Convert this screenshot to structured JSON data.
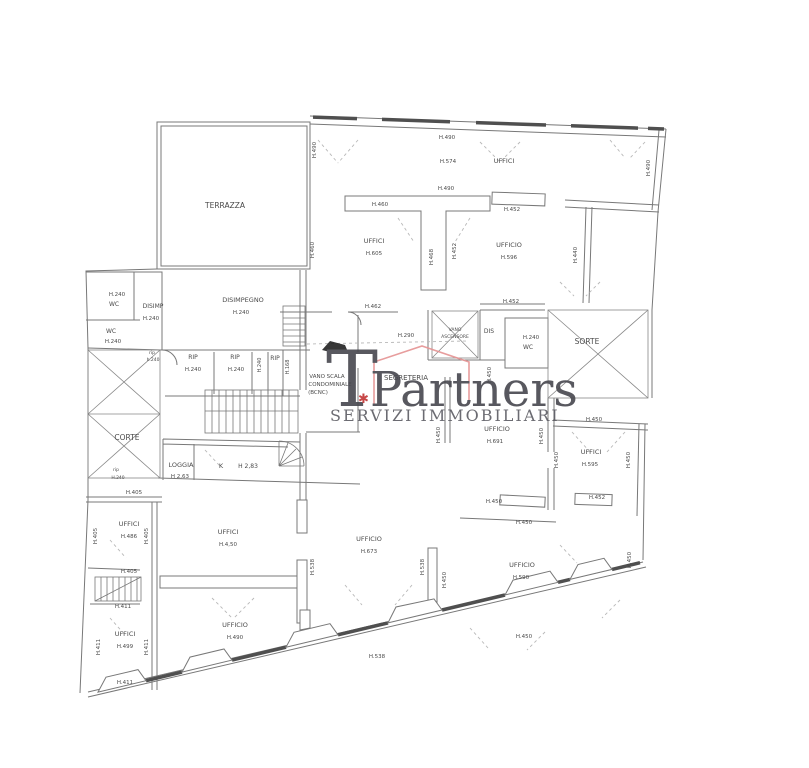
{
  "watermark": {
    "t_letter": "T",
    "brand": "Partners",
    "tagline": "SERVIZI IMMOBILIARI",
    "accent_mark": "✱",
    "brand_color": "#47474e",
    "tagline_color": "#5c5c63",
    "roof_color": "#e59393",
    "accent_color": "#c13434"
  },
  "plan": {
    "wall_color": "#787878",
    "thick_wall_color": "#4f4f4f",
    "dash_color": "#b8b8b8",
    "label_color": "#4a4a4a",
    "labels": [
      {
        "t": "TERRAZZA",
        "x": 225,
        "y": 208,
        "s": 7.5
      },
      {
        "t": "H.490",
        "x": 316,
        "y": 150,
        "s": 5.5,
        "r": -90
      },
      {
        "t": "H.460",
        "x": 314,
        "y": 250,
        "s": 5.5,
        "r": -90
      },
      {
        "t": "H.490",
        "x": 447,
        "y": 139,
        "s": 5.5
      },
      {
        "t": "H.574",
        "x": 448,
        "y": 163,
        "s": 5.5
      },
      {
        "t": "UFFICI",
        "x": 504,
        "y": 163,
        "s": 6.5
      },
      {
        "t": "H.490",
        "x": 650,
        "y": 168,
        "s": 5.5,
        "r": -90
      },
      {
        "t": "H.490",
        "x": 446,
        "y": 190,
        "s": 5.5
      },
      {
        "t": "H.460",
        "x": 380,
        "y": 206,
        "s": 5.5
      },
      {
        "t": "H.452",
        "x": 512,
        "y": 211,
        "s": 5.5
      },
      {
        "t": "UFFICI",
        "x": 374,
        "y": 243,
        "s": 6.5
      },
      {
        "t": "H.605",
        "x": 374,
        "y": 255,
        "s": 5.5
      },
      {
        "t": "H.468",
        "x": 433,
        "y": 257,
        "s": 5.5,
        "r": -90
      },
      {
        "t": "H.452",
        "x": 456,
        "y": 251,
        "s": 5.5,
        "r": -90
      },
      {
        "t": "UFFICIO",
        "x": 509,
        "y": 247,
        "s": 6.5
      },
      {
        "t": "H.596",
        "x": 509,
        "y": 259,
        "s": 5.5
      },
      {
        "t": "H.440",
        "x": 577,
        "y": 255,
        "s": 5.5,
        "r": -90
      },
      {
        "t": "H.240",
        "x": 117,
        "y": 296,
        "s": 5.5
      },
      {
        "t": "WC",
        "x": 114,
        "y": 306,
        "s": 6
      },
      {
        "t": "DISIMP",
        "x": 153,
        "y": 308,
        "s": 6
      },
      {
        "t": "H.240",
        "x": 151,
        "y": 320,
        "s": 5.5
      },
      {
        "t": "DISIMPEGNO",
        "x": 243,
        "y": 302,
        "s": 6.5
      },
      {
        "t": "H.240",
        "x": 241,
        "y": 314,
        "s": 5.5
      },
      {
        "t": "WC",
        "x": 111,
        "y": 333,
        "s": 6
      },
      {
        "t": "H.240",
        "x": 113,
        "y": 343,
        "s": 5.5
      },
      {
        "t": "rip",
        "x": 152,
        "y": 354,
        "s": 4.5
      },
      {
        "t": "h.240",
        "x": 153,
        "y": 361,
        "s": 4.5
      },
      {
        "t": "RIP",
        "x": 193,
        "y": 359,
        "s": 6
      },
      {
        "t": "H.240",
        "x": 193,
        "y": 371,
        "s": 5.5
      },
      {
        "t": "RIP",
        "x": 235,
        "y": 359,
        "s": 6
      },
      {
        "t": "H.240",
        "x": 236,
        "y": 371,
        "s": 5.5
      },
      {
        "t": "H.240",
        "x": 261,
        "y": 365,
        "s": 5,
        "r": -90
      },
      {
        "t": "RIP",
        "x": 275,
        "y": 360,
        "s": 6
      },
      {
        "t": "H.168",
        "x": 289,
        "y": 367,
        "s": 5,
        "r": -90
      },
      {
        "t": "H.462",
        "x": 373,
        "y": 308,
        "s": 5.5
      },
      {
        "t": "H.290",
        "x": 406,
        "y": 337,
        "s": 5.5
      },
      {
        "t": "VANO",
        "x": 455,
        "y": 331,
        "s": 4.5
      },
      {
        "t": "ASCENSORE",
        "x": 455,
        "y": 338,
        "s": 4.5
      },
      {
        "t": "DIS",
        "x": 489,
        "y": 333,
        "s": 6
      },
      {
        "t": "H.452",
        "x": 511,
        "y": 303,
        "s": 5.5
      },
      {
        "t": "H.240",
        "x": 531,
        "y": 339,
        "s": 5.5
      },
      {
        "t": "WC",
        "x": 528,
        "y": 349,
        "s": 6
      },
      {
        "t": "SORTE",
        "x": 587,
        "y": 344,
        "s": 7.5
      },
      {
        "t": "VANO SCALA",
        "x": 327,
        "y": 378,
        "s": 5.5
      },
      {
        "t": "CONDOMINIALE",
        "x": 330,
        "y": 386,
        "s": 5.5
      },
      {
        "t": "(BCNC)",
        "x": 318,
        "y": 394,
        "s": 5.5
      },
      {
        "t": "SEGRETERIA",
        "x": 406,
        "y": 380,
        "s": 7
      },
      {
        "t": "H.450",
        "x": 491,
        "y": 375,
        "s": 5.5,
        "r": -90
      },
      {
        "t": "H.450",
        "x": 594,
        "y": 421,
        "s": 5.5
      },
      {
        "t": "UFFICIO",
        "x": 497,
        "y": 431,
        "s": 6.5
      },
      {
        "t": "H.691",
        "x": 495,
        "y": 443,
        "s": 5.5
      },
      {
        "t": "H.450",
        "x": 440,
        "y": 435,
        "s": 5.5,
        "r": -90
      },
      {
        "t": "H.450",
        "x": 543,
        "y": 436,
        "s": 5.5,
        "r": -90
      },
      {
        "t": "H.450",
        "x": 558,
        "y": 460,
        "s": 5.5,
        "r": -90
      },
      {
        "t": "UFFICI",
        "x": 591,
        "y": 454,
        "s": 6.5
      },
      {
        "t": "H.595",
        "x": 590,
        "y": 466,
        "s": 5.5
      },
      {
        "t": "H.450",
        "x": 630,
        "y": 460,
        "s": 5.5,
        "r": -90
      },
      {
        "t": "CORTE",
        "x": 127,
        "y": 440,
        "s": 7.5
      },
      {
        "t": "rip",
        "x": 116,
        "y": 471,
        "s": 4.5
      },
      {
        "t": "H.240",
        "x": 118,
        "y": 479,
        "s": 4.5
      },
      {
        "t": "LOGGIA",
        "x": 181,
        "y": 467,
        "s": 6.5
      },
      {
        "t": "H 2,63",
        "x": 180,
        "y": 478,
        "s": 5.5
      },
      {
        "t": "K",
        "x": 221,
        "y": 468,
        "s": 6.5
      },
      {
        "t": "H 2,83",
        "x": 248,
        "y": 468,
        "s": 6
      },
      {
        "t": "H.405",
        "x": 134,
        "y": 494,
        "s": 5.5
      },
      {
        "t": "H.405",
        "x": 97,
        "y": 536,
        "s": 5.5,
        "r": -90
      },
      {
        "t": "UFFICI",
        "x": 129,
        "y": 526,
        "s": 6.5
      },
      {
        "t": "H.486",
        "x": 129,
        "y": 538,
        "s": 5.5
      },
      {
        "t": "H.405",
        "x": 148,
        "y": 536,
        "s": 5.5,
        "r": -90
      },
      {
        "t": "UFFICI",
        "x": 228,
        "y": 534,
        "s": 6.5
      },
      {
        "t": "H.4,50",
        "x": 228,
        "y": 546,
        "s": 5.5
      },
      {
        "t": "H.405",
        "x": 129,
        "y": 573,
        "s": 5.5
      },
      {
        "t": "H.411",
        "x": 123,
        "y": 608,
        "s": 5.5
      },
      {
        "t": "H.411",
        "x": 100,
        "y": 647,
        "s": 5.5,
        "r": -90
      },
      {
        "t": "UFFICI",
        "x": 125,
        "y": 636,
        "s": 6.5
      },
      {
        "t": "H.499",
        "x": 125,
        "y": 648,
        "s": 5.5
      },
      {
        "t": "H.411",
        "x": 148,
        "y": 647,
        "s": 5.5,
        "r": -90
      },
      {
        "t": "H.411",
        "x": 125,
        "y": 684,
        "s": 5.5
      },
      {
        "t": "UFFICIO",
        "x": 369,
        "y": 541,
        "s": 6.5
      },
      {
        "t": "H.673",
        "x": 369,
        "y": 553,
        "s": 5.5
      },
      {
        "t": "H.538",
        "x": 314,
        "y": 567,
        "s": 5.5,
        "r": -90
      },
      {
        "t": "H.538",
        "x": 424,
        "y": 567,
        "s": 5.5,
        "r": -90
      },
      {
        "t": "UFFICIO",
        "x": 235,
        "y": 627,
        "s": 6.5
      },
      {
        "t": "H.490",
        "x": 235,
        "y": 639,
        "s": 5.5
      },
      {
        "t": "H.538",
        "x": 377,
        "y": 658,
        "s": 5.5
      },
      {
        "t": "H.450",
        "x": 494,
        "y": 503,
        "s": 5.5
      },
      {
        "t": "H.452",
        "x": 597,
        "y": 499,
        "s": 5.5
      },
      {
        "t": "H.450",
        "x": 524,
        "y": 524,
        "s": 5.5
      },
      {
        "t": "UFFICIO",
        "x": 522,
        "y": 567,
        "s": 6.5
      },
      {
        "t": "H.590",
        "x": 521,
        "y": 579,
        "s": 5.5
      },
      {
        "t": "H.450",
        "x": 631,
        "y": 560,
        "s": 5.5,
        "r": -90
      },
      {
        "t": "H.450",
        "x": 446,
        "y": 580,
        "s": 5.5,
        "r": -90
      },
      {
        "t": "H.450",
        "x": 524,
        "y": 638,
        "s": 5.5
      }
    ]
  }
}
